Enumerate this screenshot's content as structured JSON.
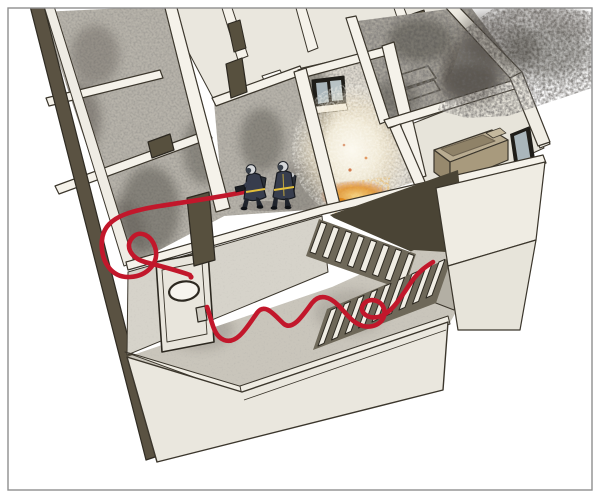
{
  "figure": {
    "kind": "isometric-cutaway-illustration",
    "subject": "Two firefighters with breathing apparatus advance a charged hose line through a smoke-filled upper floor toward a burning room; the hose runs from a switchback staircase across a lower landing, past a self-closing fire door with an oval vision panel, with an excess-hose loop laid before the nozzle; smoke vents from the top-right of the building.",
    "firefighter_count": 2,
    "stair_flights": 2,
    "hose_loops": 1,
    "elements": [
      {
        "name": "building-cutaway",
        "label": "building floor cutaway"
      },
      {
        "name": "smoke-layer",
        "label": "smoke-filled rooms"
      },
      {
        "name": "smoke-plume",
        "label": "smoke venting outside"
      },
      {
        "name": "fire-room",
        "label": "room with fire and steam"
      },
      {
        "name": "firefighter-pair",
        "label": "two firefighters with SCBA"
      },
      {
        "name": "hose-line",
        "label": "red attack hose with loop"
      },
      {
        "name": "staircase",
        "label": "switchback staircase"
      },
      {
        "name": "fire-door",
        "label": "fire door with oval window"
      },
      {
        "name": "bathtub",
        "label": "bathtub"
      },
      {
        "name": "window",
        "label": "window"
      }
    ],
    "palette": {
      "background": "#ffffff",
      "frame": "#8f8f8f",
      "outline": "#3b362c",
      "wall_top": "#f5f2ea",
      "wall_face": "#edebe2",
      "wall_cut_dark": "#5a5242",
      "door_wall_face": "#d6d3ca",
      "floor_clean": "#eae7de",
      "floor_smoke_base": "#b7b3aa",
      "floor_fire_room": "#ded9cf",
      "floor_hall": "#c9c5bb",
      "smoke_dark": "#4a463f",
      "steam_white": "#fcf9ef",
      "steam_mid": "#f3ecd8",
      "fire_orange": "#e08a1e",
      "fire_deep": "#c2490e",
      "hose_red": "#c2172b",
      "turnout_navy": "#373d4d",
      "turnout_dark": "#20242c",
      "stripe_yellow": "#e3bf3a",
      "helmet_grey": "#d6d8da",
      "mask_dark": "#39404a",
      "glass_blue": "#aab6bb",
      "tub_tan": "#b9ac91",
      "tub_shadow": "#6e6350",
      "stair_tread": "#f0ede4",
      "stair_under": "#6e6859",
      "stair_void": "#4a4435"
    }
  }
}
